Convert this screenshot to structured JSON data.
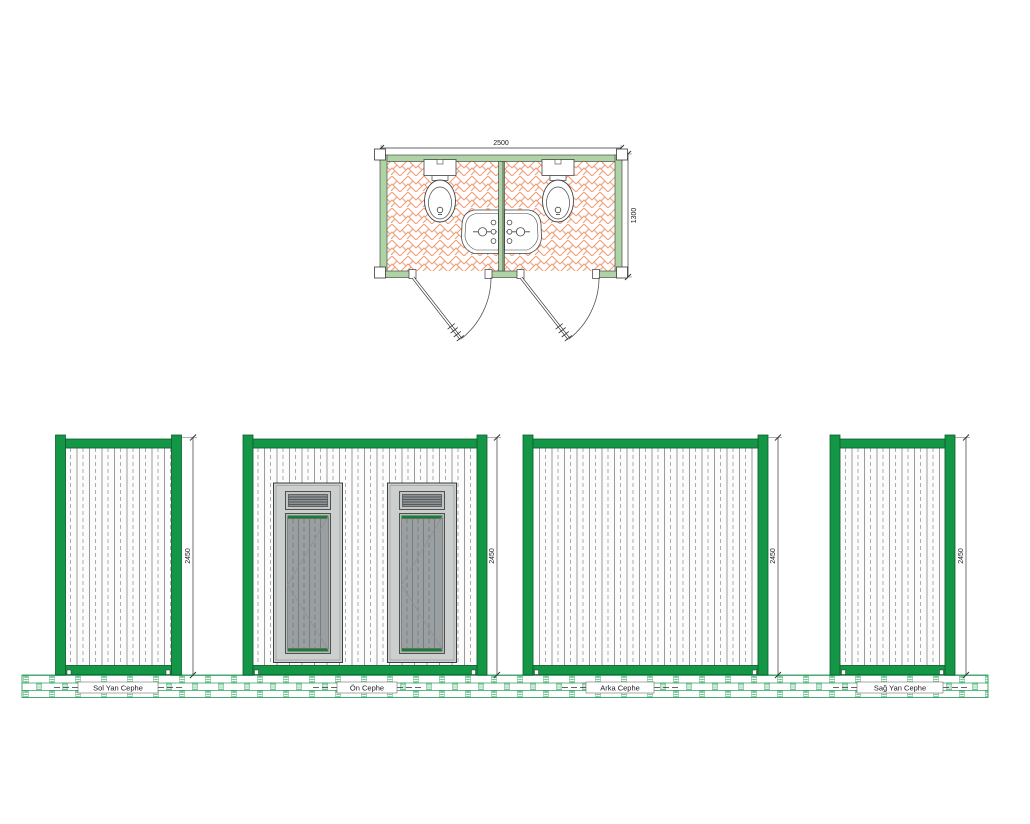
{
  "drawing": {
    "plan": {
      "name": "WC container floor plan",
      "width_dim": "2500",
      "height_dim": "1300",
      "rooms": 2,
      "fixtures": [
        "toilet",
        "toilet",
        "washbasin",
        "washbasin"
      ],
      "doors": 2
    },
    "elevations": [
      {
        "id": "sol-yan",
        "label": "Sol Yan Cephe",
        "height_dim": "2450"
      },
      {
        "id": "on",
        "label": "Ön Cephe",
        "height_dim": "2450"
      },
      {
        "id": "arka",
        "label": "Arka Cephe",
        "height_dim": "2450"
      },
      {
        "id": "sag-yan",
        "label": "Sağ Yan Cephe",
        "height_dim": "2450"
      }
    ],
    "colors": {
      "frame_green": "#149647",
      "frame_outline": "#0d5d2e",
      "plan_wall_green": "#aed3a4",
      "floor_tile_line": "#f19a74",
      "ground_brick_green": "#2fa060",
      "door_frame_gray": "#cbcfce",
      "door_panel_gray": "#9aa0a2",
      "door_trim_green": "#1c7a39"
    }
  }
}
